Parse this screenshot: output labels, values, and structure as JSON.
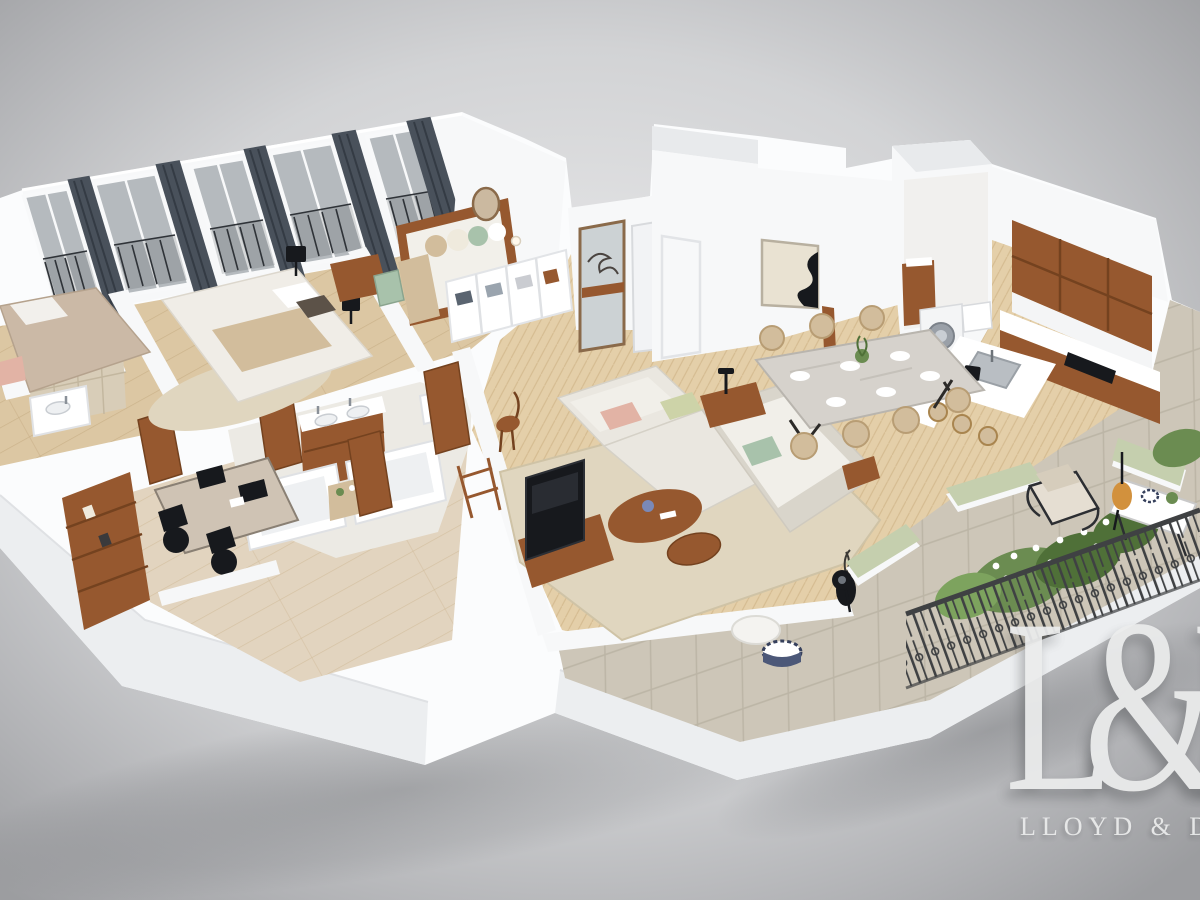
{
  "watermark": {
    "monogram": "L&D",
    "wordmark": "LLOYD & D"
  },
  "scene": {
    "type": "isometric 3d floor plan render of an apartment, aerial cutaway view on gray studio background",
    "rooms": [
      "bedroom-1",
      "master-bedroom",
      "guest-room-daybed",
      "walk-in-closet",
      "bathroom-1",
      "shower-bathroom",
      "wc",
      "home-office",
      "hallway",
      "entry-hall",
      "living-room",
      "dining-area",
      "kitchen",
      "laundry-room",
      "terrace"
    ],
    "features": {
      "french-windows-with-balconettes": 5,
      "curtain-panels": 5,
      "dining-seats": 7,
      "bar-stools": 3,
      "sofa-type": "L-shaped cream sectional",
      "flooring": [
        "oak planks",
        "herringbone parquet",
        "stone tile terrace"
      ]
    },
    "palette": {
      "bgInner": "#ededee",
      "bgMid": "#c9cacc",
      "bgOuter": "#9c9da0",
      "wall": "#f7f8f9",
      "wallShade": "#e8eaec",
      "plinth": "#fbfcfd",
      "plinthFace": "#eceef0",
      "wood": "#dcc7a3",
      "herring": "#e4cfa9",
      "office": "#e2d4bf",
      "tile": "#cdc6b8",
      "walnut": "#96582f",
      "walnutDark": "#74421f",
      "cream": "#eae7e0",
      "creamShade": "#d9d5cb",
      "rug": "#e0d6bf",
      "marble": "#d6d2cc",
      "tan": "#d2bd9c",
      "curtain": "#49515b",
      "iron": "#3f4143",
      "glass": "#b5babe",
      "sage": "#c5cfae",
      "pink": "#e2b3a5",
      "celadon": "#a8c2ab",
      "green": "#6b8c51",
      "greenDark": "#4f7038",
      "amber": "#d2913d",
      "dark": "#17191d",
      "logo": "#ebecec"
    }
  }
}
